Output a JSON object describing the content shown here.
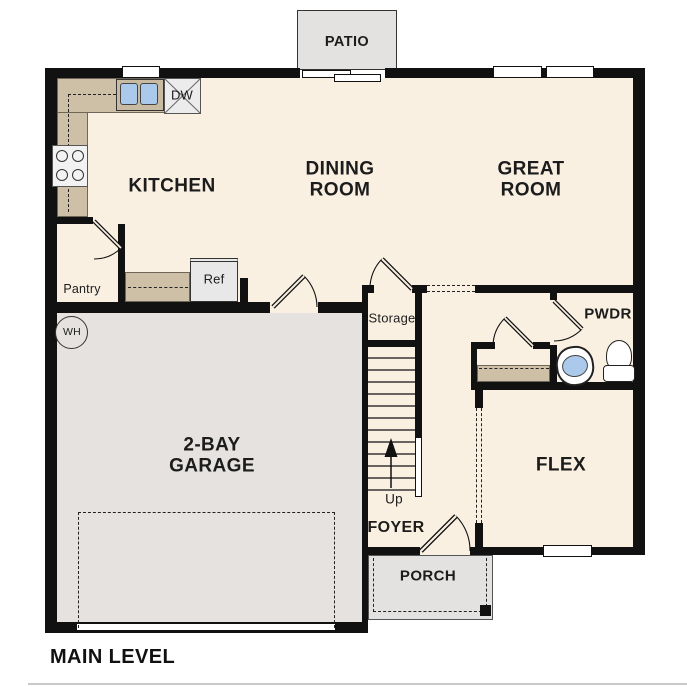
{
  "plan_title": "MAIN LEVEL",
  "rooms": {
    "kitchen": {
      "label": "KITCHEN"
    },
    "dining_room": {
      "label": "DINING ROOM"
    },
    "great_room": {
      "label": "GREAT ROOM"
    },
    "garage": {
      "label": "2-BAY GARAGE"
    },
    "flex": {
      "label": "FLEX"
    },
    "foyer": {
      "label": "FOYER"
    },
    "powder_room": {
      "label": "PWDR"
    },
    "storage": {
      "label": "Storage"
    },
    "pantry": {
      "label": "Pantry"
    }
  },
  "outdoor": {
    "patio": {
      "label": "PATIO"
    },
    "porch": {
      "label": "PORCH"
    }
  },
  "fixtures": {
    "refrigerator": {
      "label": "Ref"
    },
    "dishwasher": {
      "label": "DW"
    },
    "water_heater": {
      "label": "WH"
    },
    "stairs": {
      "direction_label": "Up"
    }
  },
  "colors": {
    "wall": "#111111",
    "floor": "#faf0e2",
    "garage_floor": "#e5e2df",
    "concrete": "#e3e2e1",
    "counter": "#cec0a6",
    "sink_blue": "#aac9eb",
    "background": "#ffffff"
  }
}
